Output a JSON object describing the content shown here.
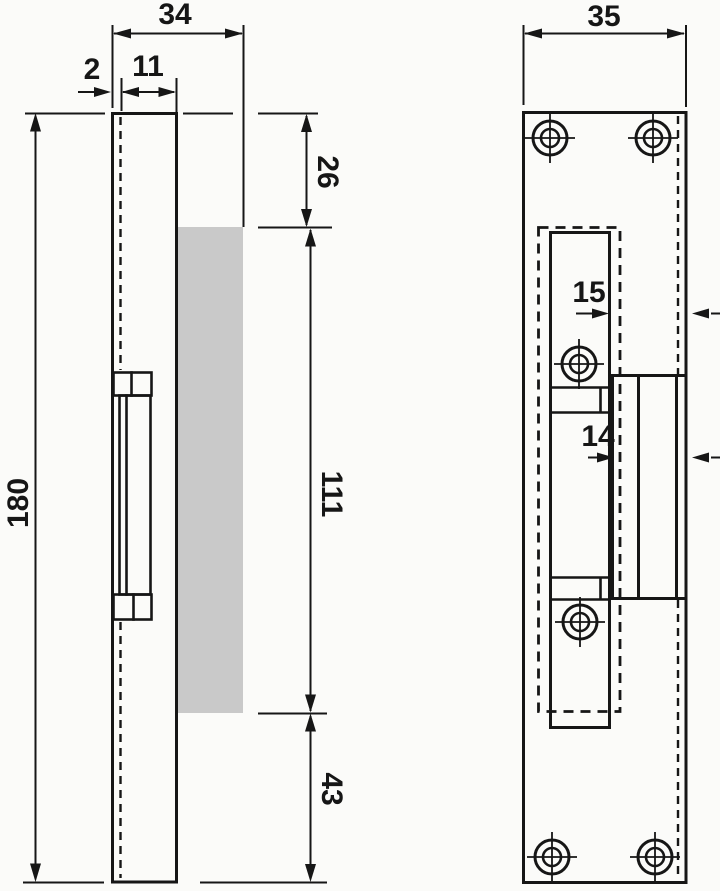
{
  "colors": {
    "line": "#161616",
    "background": "#fbfbf9",
    "highlight_gray": "#c9c9c9"
  },
  "side_view": {
    "dims": {
      "overall_width": "34",
      "plate_thickness": "2",
      "box_depth": "11",
      "overall_height": "180",
      "top_section": "26",
      "middle_section": "111",
      "bottom_section": "43"
    }
  },
  "front_view": {
    "dims": {
      "overall_width": "35",
      "upper_offset": "15",
      "lower_offset": "14"
    }
  }
}
